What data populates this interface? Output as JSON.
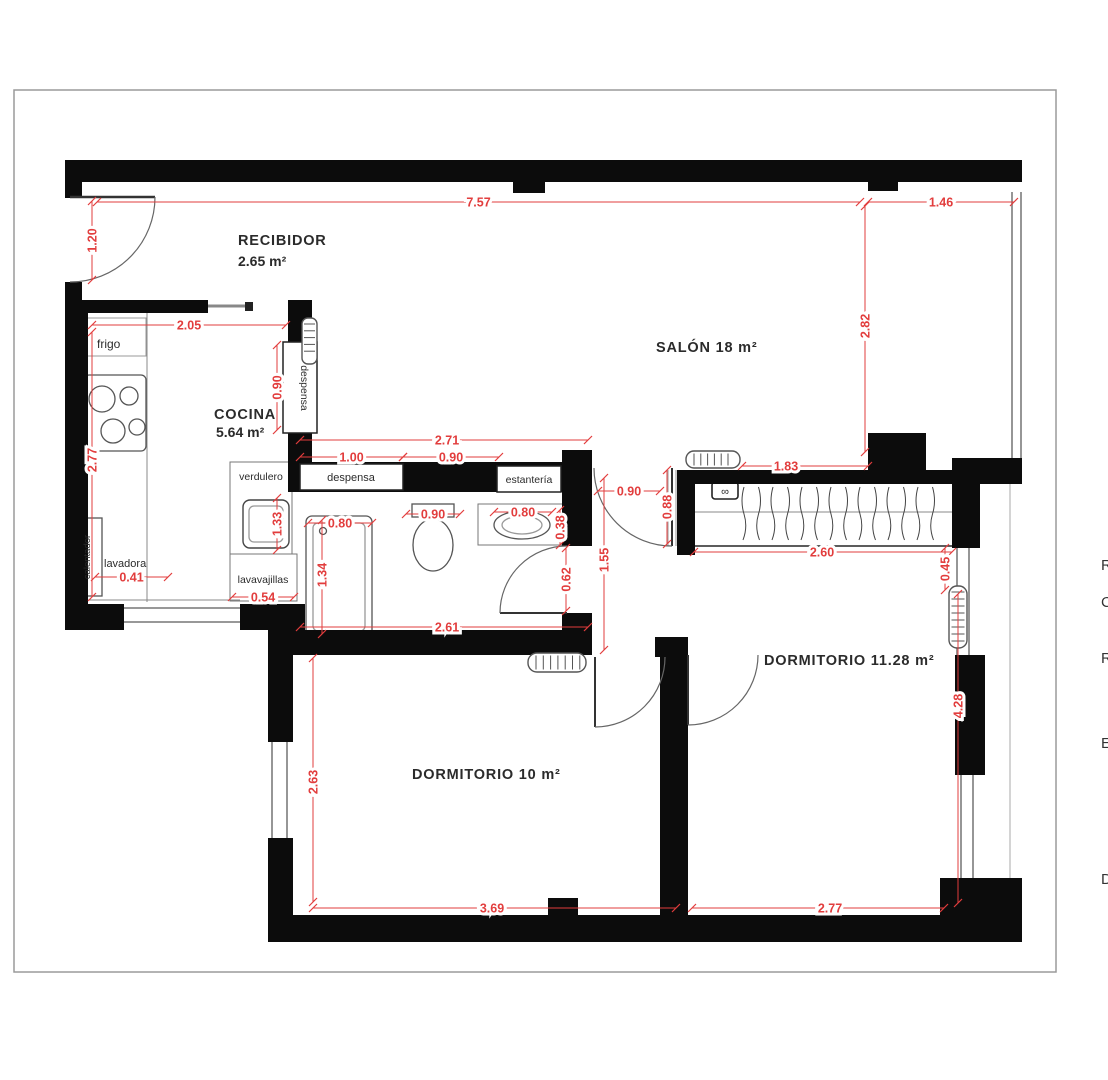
{
  "plan": {
    "type": "floor-plan",
    "colors": {
      "wall": "#0c0c0c",
      "dimension_red": "#e23d3d",
      "label_dark": "#2b2b2b",
      "line_gray": "#666666",
      "frame_gray": "#9a9a9a"
    },
    "rooms": [
      {
        "label": "RECIBIDOR",
        "area_label": "2.65 m²",
        "x": 238,
        "y": 245,
        "area_x": 238,
        "area_y": 266
      },
      {
        "label": "SALÓN 18 m²",
        "x": 656,
        "y": 352
      },
      {
        "label": "COCINA",
        "area_label": "5.64 m²",
        "x": 214,
        "y": 419,
        "area_x": 216,
        "area_y": 437
      },
      {
        "label": "DORMITORIO 10 m²",
        "x": 412,
        "y": 779
      },
      {
        "label": "DORMITORIO 11.28 m²",
        "x": 764,
        "y": 665
      }
    ],
    "fixture_labels": [
      {
        "t": "frigo",
        "x": 97,
        "y": 348,
        "s": 12,
        "a": "s"
      },
      {
        "t": "lavadora",
        "x": 104,
        "y": 567,
        "s": 11,
        "a": "s"
      },
      {
        "t": "calentador",
        "x": 90,
        "y": 557,
        "s": 9.5,
        "a": "m",
        "r": -90
      },
      {
        "t": "verdulero",
        "x": 261,
        "y": 480,
        "s": 10.5,
        "a": "m"
      },
      {
        "t": "lavavajillas",
        "x": 263,
        "y": 583,
        "s": 10.5,
        "a": "m"
      },
      {
        "t": "despensa",
        "x": 351,
        "y": 481,
        "s": 11,
        "a": "m"
      },
      {
        "t": "estantería",
        "x": 529,
        "y": 483,
        "s": 10.5,
        "a": "m"
      },
      {
        "t": "despensa",
        "x": 301,
        "y": 388,
        "s": 10.5,
        "a": "m",
        "r": 90
      },
      {
        "t": "∞",
        "x": 725,
        "y": 495,
        "s": 11,
        "a": "m"
      }
    ],
    "dimensions": [
      {
        "v": "7.57",
        "x1": 97,
        "y1": 202,
        "x2": 860,
        "y2": 202
      },
      {
        "v": "1.46",
        "x1": 868,
        "y1": 202,
        "x2": 1014,
        "y2": 202
      },
      {
        "v": "1.20",
        "x1": 92,
        "y1": 201,
        "x2": 92,
        "y2": 280,
        "vert": 1
      },
      {
        "v": "2.82",
        "x1": 865,
        "y1": 206,
        "x2": 865,
        "y2": 452,
        "vert": 1,
        "ty": 326
      },
      {
        "v": "2.05",
        "x1": 92,
        "y1": 325,
        "x2": 286,
        "y2": 325
      },
      {
        "v": "0.90",
        "x1": 277,
        "y1": 345,
        "x2": 277,
        "y2": 430,
        "vert": 1
      },
      {
        "v": "2.77",
        "x1": 92,
        "y1": 332,
        "x2": 92,
        "y2": 597,
        "vert": 1,
        "ty": 460
      },
      {
        "v": "0.41",
        "x1": 95,
        "y1": 577,
        "x2": 168,
        "y2": 577
      },
      {
        "v": "1.33",
        "x1": 277,
        "y1": 498,
        "x2": 277,
        "y2": 550,
        "vert": 1
      },
      {
        "v": "0.54",
        "x1": 232,
        "y1": 597,
        "x2": 294,
        "y2": 597
      },
      {
        "v": "2.71",
        "x1": 300,
        "y1": 440,
        "x2": 588,
        "y2": 440,
        "tx": 447
      },
      {
        "v": "1.00",
        "x1": 300,
        "y1": 457,
        "x2": 403,
        "y2": 457
      },
      {
        "v": "0.90",
        "x1": 403,
        "y1": 457,
        "x2": 499,
        "y2": 457
      },
      {
        "v": "0.80",
        "x1": 308,
        "y1": 523,
        "x2": 372,
        "y2": 523
      },
      {
        "v": "1.34",
        "x1": 322,
        "y1": 520,
        "x2": 322,
        "y2": 634,
        "vert": 1,
        "ty": 575
      },
      {
        "v": "0.90",
        "x1": 406,
        "y1": 514,
        "x2": 460,
        "y2": 514
      },
      {
        "v": "0.80",
        "x1": 494,
        "y1": 512,
        "x2": 552,
        "y2": 512
      },
      {
        "v": "0.38",
        "x1": 560,
        "y1": 510,
        "x2": 560,
        "y2": 545,
        "vert": 1
      },
      {
        "v": "0.62",
        "x1": 566,
        "y1": 548,
        "x2": 566,
        "y2": 611,
        "vert": 1
      },
      {
        "v": "1.55",
        "x1": 604,
        "y1": 478,
        "x2": 604,
        "y2": 650,
        "vert": 1,
        "ty": 560
      },
      {
        "v": "2.61",
        "x1": 300,
        "y1": 627,
        "x2": 588,
        "y2": 627,
        "tx": 447
      },
      {
        "v": "0.90",
        "x1": 598,
        "y1": 491,
        "x2": 660,
        "y2": 491
      },
      {
        "v": "0.88",
        "x1": 667,
        "y1": 470,
        "x2": 667,
        "y2": 544,
        "vert": 1
      },
      {
        "v": "1.83",
        "x1": 742,
        "y1": 466,
        "x2": 868,
        "y2": 466,
        "tx": 786
      },
      {
        "v": "2.60",
        "x1": 694,
        "y1": 552,
        "x2": 952,
        "y2": 552,
        "tx": 822
      },
      {
        "v": "0.45",
        "x1": 945,
        "y1": 548,
        "x2": 945,
        "y2": 590,
        "vert": 1
      },
      {
        "v": "4.28",
        "x1": 958,
        "y1": 594,
        "x2": 958,
        "y2": 903,
        "vert": 1,
        "ty": 706
      },
      {
        "v": "2.63",
        "x1": 313,
        "y1": 658,
        "x2": 313,
        "y2": 902,
        "vert": 1,
        "ty": 782
      },
      {
        "v": "3.69",
        "x1": 313,
        "y1": 908,
        "x2": 676,
        "y2": 908,
        "tx": 492
      },
      {
        "v": "2.77",
        "x1": 692,
        "y1": 908,
        "x2": 944,
        "y2": 908,
        "tx": 830
      }
    ],
    "edge_fragments": [
      {
        "t": "R",
        "y": 570
      },
      {
        "t": "C",
        "y": 607
      },
      {
        "t": "R",
        "y": 663
      },
      {
        "t": "E",
        "y": 748
      },
      {
        "t": "D",
        "y": 884
      }
    ]
  }
}
